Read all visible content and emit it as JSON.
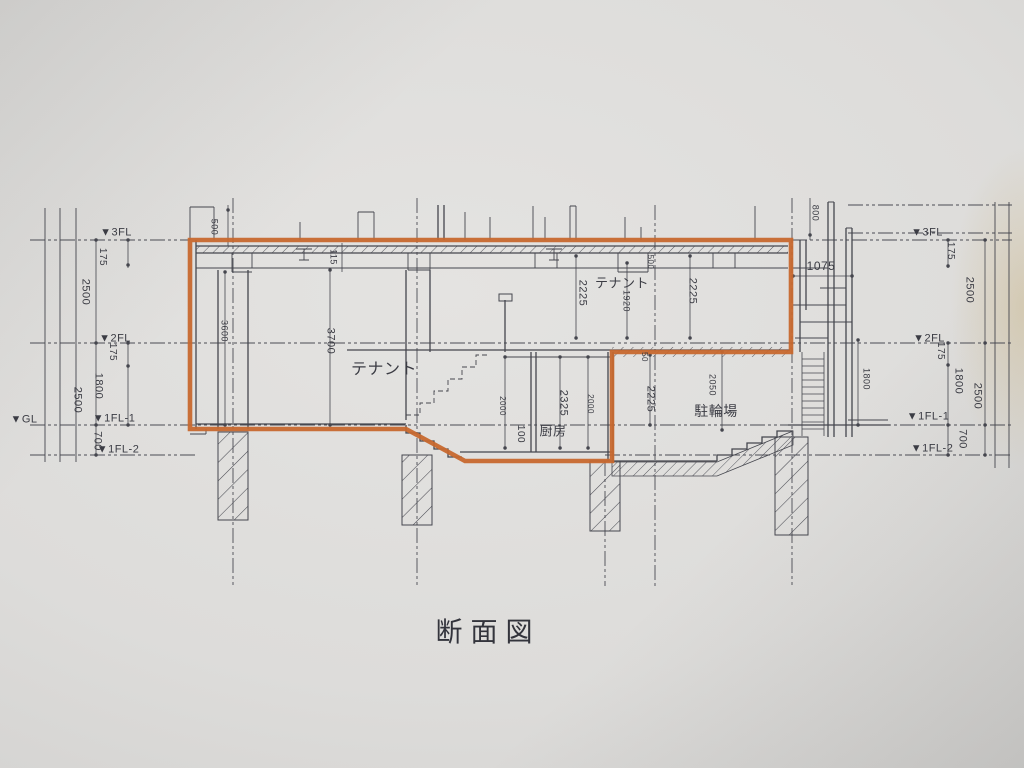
{
  "title": "断面図",
  "colors": {
    "highlight_orange": "#c7682e",
    "ink": "#45464e",
    "paper": "#dddcda"
  },
  "floor_markers": {
    "left": {
      "fl3": "▼3FL",
      "fl2": "▼2FL",
      "gl": "▼GL",
      "fl1_1": "▼1FL-1",
      "fl1_2": "▼1FL-2"
    },
    "right": {
      "fl3": "▼3FL",
      "fl2": "▼2FL",
      "fl1_1": "▼1FL-1",
      "fl1_2": "▼1FL-2"
    }
  },
  "dimensions": {
    "left": {
      "d500": "500",
      "d175_upper": "175",
      "d2500_upper": "2500",
      "d175_lower": "175",
      "d1800": "1800",
      "d2500_lower": "2500",
      "d700": "700"
    },
    "right": {
      "d800": "800",
      "d175_upper": "175",
      "d2500_upper": "2500",
      "d175_lower": "175",
      "d1800": "1800",
      "d2500_lower": "2500",
      "d700": "700",
      "d1075": "1075",
      "d1800_stair": "1800"
    },
    "interior": {
      "d115": "115",
      "d3600": "3600",
      "d3700": "3700",
      "d2225_2f_left": "2225",
      "d1920": "1920",
      "d2225_2f_right": "2225",
      "d500_2f": "500",
      "d2000_left": "2000",
      "d2325": "2325",
      "d2000_right": "2000",
      "d100": "100",
      "d2225_bike": "2225",
      "d2050": "2050",
      "d50": "50"
    }
  },
  "rooms": {
    "tenant_1f": "テナント",
    "tenant_2f": "テナント",
    "kitchen": "厨房",
    "bicycle_parking": "駐輪場"
  }
}
